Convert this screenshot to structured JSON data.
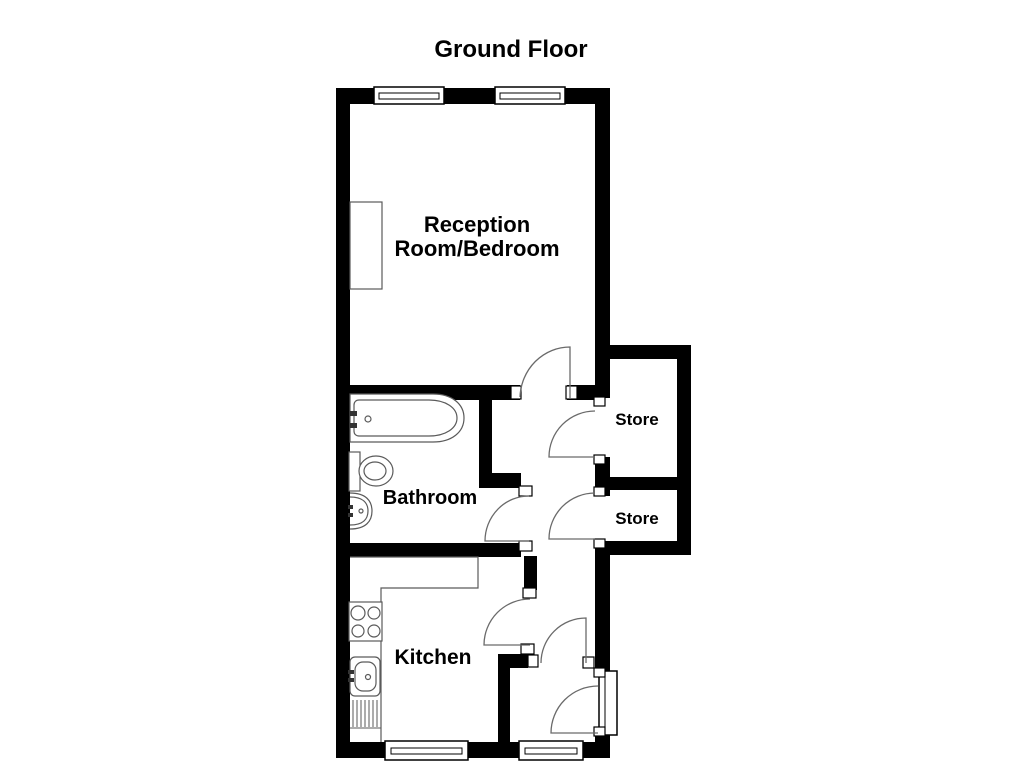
{
  "title": "Ground Floor",
  "rooms": {
    "reception": {
      "label_line1": "Reception",
      "label_line2": "Room/Bedroom"
    },
    "store_upper": {
      "label": "Store"
    },
    "store_lower": {
      "label": "Store"
    },
    "bathroom": {
      "label": "Bathroom"
    },
    "kitchen": {
      "label": "Kitchen"
    }
  },
  "colors": {
    "wall": "#000000",
    "background": "#ffffff",
    "door_line": "#6a6a6a",
    "fixture_line": "#5a5a5a",
    "text": "#000000"
  }
}
